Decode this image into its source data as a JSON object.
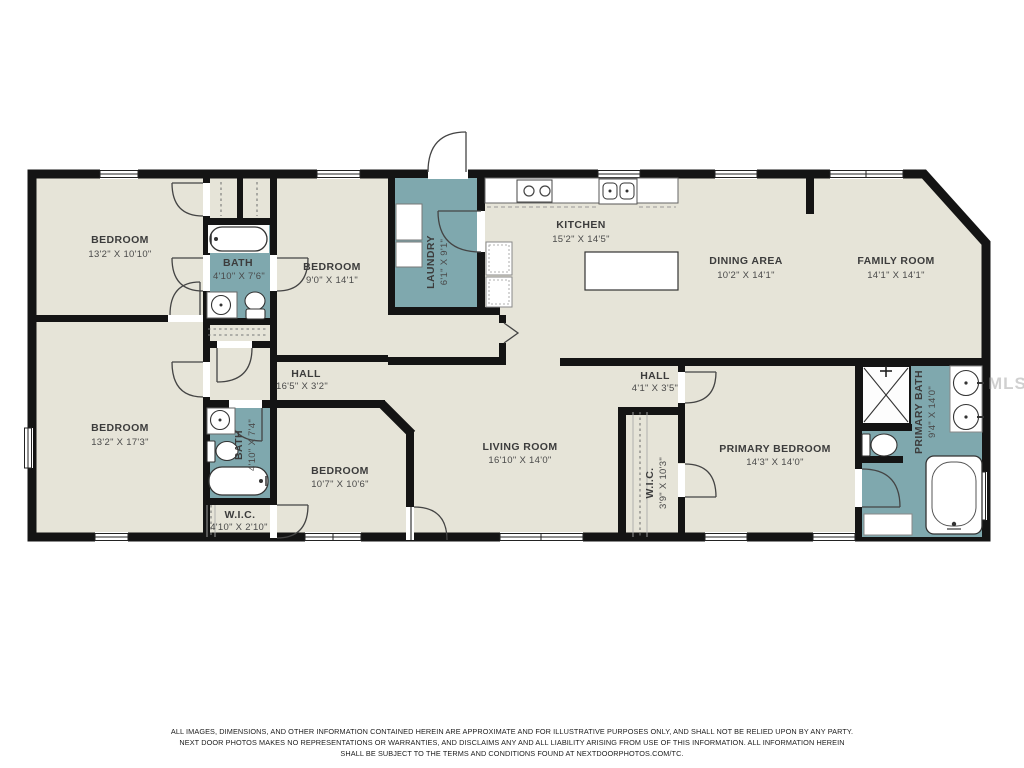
{
  "colors": {
    "floor": "#e6e4d8",
    "wet_room": "#7fa8ae",
    "wall": "#141414",
    "label": "#3c3c3c"
  },
  "watermark": "MLS",
  "rooms": [
    {
      "id": "bedroom-top-left",
      "name": "BEDROOM",
      "dims": "13'2\" X 10'10\""
    },
    {
      "id": "bath-hall",
      "name": "BATH",
      "dims": "4'10\" X 7'6\""
    },
    {
      "id": "bedroom-2",
      "name": "BEDROOM",
      "dims": "9'0\" X 14'1\""
    },
    {
      "id": "laundry",
      "name": "LAUNDRY",
      "dims": "6'1\" X 9'1\""
    },
    {
      "id": "kitchen",
      "name": "KITCHEN",
      "dims": "15'2\" X 14'5\""
    },
    {
      "id": "dining-area",
      "name": "DINING AREA",
      "dims": "10'2\" X 14'1\""
    },
    {
      "id": "family-room",
      "name": "FAMILY ROOM",
      "dims": "14'1\" X 14'1\""
    },
    {
      "id": "hall-long",
      "name": "HALL",
      "dims": "16'5\" X 3'2\""
    },
    {
      "id": "bedroom-3",
      "name": "BEDROOM",
      "dims": "13'2\" X 17'3\""
    },
    {
      "id": "bath-2",
      "name": "BATH",
      "dims": "4'10\" X 7'4\""
    },
    {
      "id": "bedroom-4",
      "name": "BEDROOM",
      "dims": "10'7\" X 10'6\""
    },
    {
      "id": "living-room",
      "name": "LIVING ROOM",
      "dims": "16'10\" X 14'0\""
    },
    {
      "id": "hall-small",
      "name": "HALL",
      "dims": "4'1\" X 3'5\""
    },
    {
      "id": "wic-hall",
      "name": "W.I.C.",
      "dims": "3'9\" X 10'3\""
    },
    {
      "id": "primary-bedroom",
      "name": "PRIMARY BEDROOM",
      "dims": "14'3\" X 14'0\""
    },
    {
      "id": "primary-bath",
      "name": "PRIMARY BATH",
      "dims": "9'4\" X 14'0\""
    },
    {
      "id": "wic-2",
      "name": "W.I.C.",
      "dims": "4'10\" X 2'10\""
    }
  ],
  "disclaimer": {
    "line1": "ALL IMAGES, DIMENSIONS, AND OTHER INFORMATION CONTAINED HEREIN ARE APPROXIMATE AND FOR ILLUSTRATIVE PURPOSES ONLY, AND SHALL NOT BE RELIED UPON BY ANY PARTY.",
    "line2": "NEXT DOOR PHOTOS MAKES NO REPRESENTATIONS OR WARRANTIES, AND DISCLAIMS ANY AND ALL LIABILITY ARISING FROM USE OF THIS INFORMATION. ALL INFORMATION HEREIN",
    "line3": "SHALL BE SUBJECT TO THE TERMS AND CONDITIONS FOUND AT NEXTDOORPHOTOS.COM/TC."
  }
}
